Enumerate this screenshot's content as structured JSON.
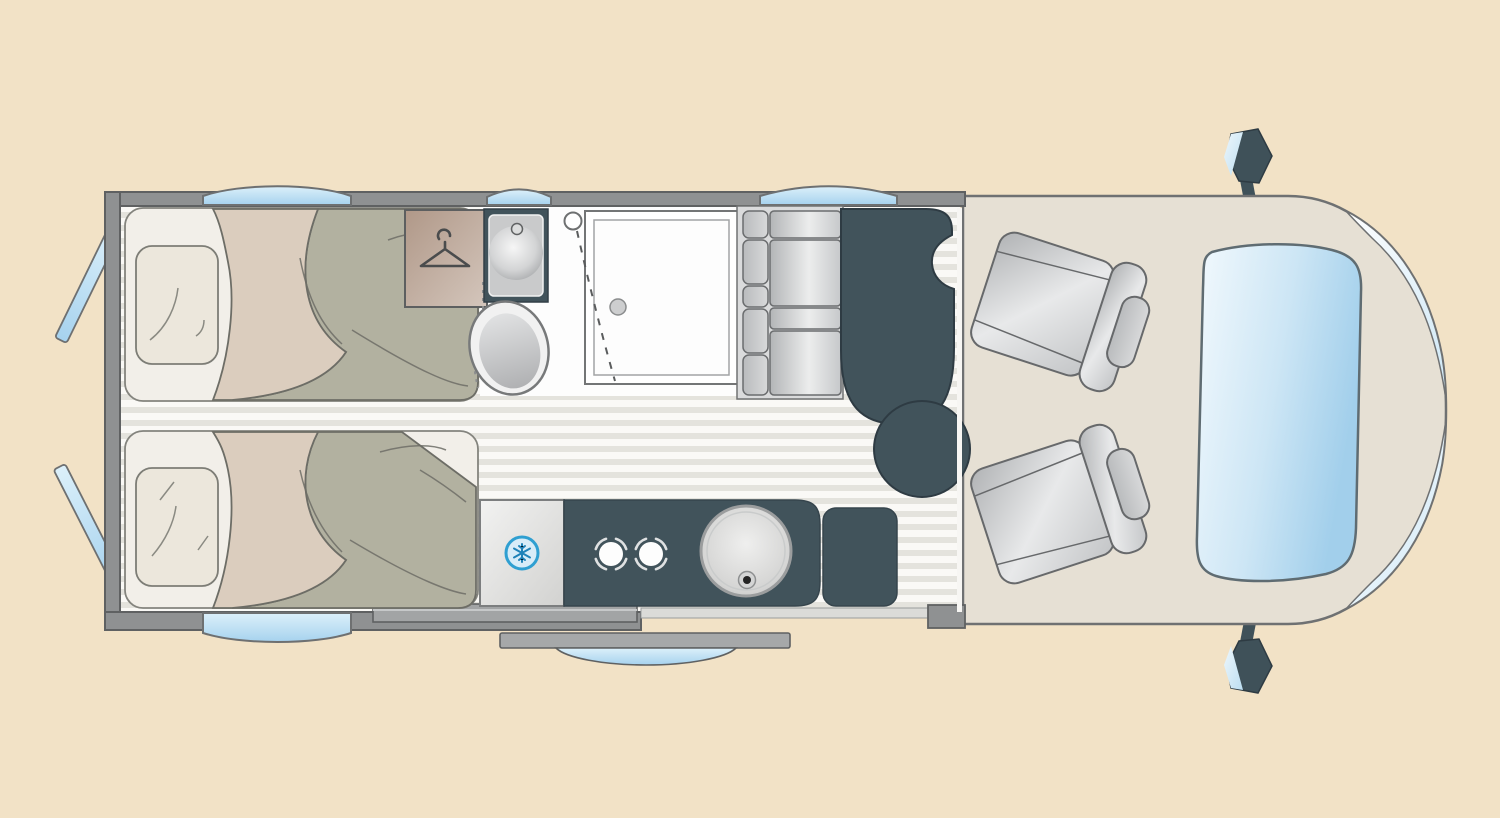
{
  "page": {
    "title": "Campervan floor plan (top view)",
    "type": "floorplan-diagram",
    "visible_text": "none"
  },
  "colors": {
    "background": "#f2e2c6",
    "wall": "#8f9192",
    "wall_outline": "#5f6162",
    "floor_base": "#faf9f6",
    "floor_stripe": "#e4e3dd",
    "bathroom_floor": "#fdfdfd",
    "cab_floor": "#e6e0d4",
    "dark_fixture": "#41535b",
    "table": "#41535b",
    "mattress": "#f2efe9",
    "pillow": "#ece7dc",
    "blanket": "#b2b1a0",
    "blanket_fold": "#dbcdbe",
    "wardrobe_brown": "#b49d90",
    "window_blue": "#aad5ef",
    "glass_light": "#d9effa",
    "accent_blue": "#2f9fd1",
    "snowflake_blue": "#1f82b8",
    "cushion_gray": "#c9cbcd",
    "step_gray": "#a2a4a5"
  },
  "elements": [
    {
      "name": "single-bed-top",
      "desc": "rear single bed with pillow and folded duvet"
    },
    {
      "name": "single-bed-bottom",
      "desc": "rear single bed with pillow and folded duvet"
    },
    {
      "name": "wardrobe",
      "desc": "wardrobe marked with clothes-hanger symbol"
    },
    {
      "name": "vanity-sink",
      "desc": "washroom basin in dark cabinet with faucet"
    },
    {
      "name": "toilet",
      "desc": "tilted toilet bowl"
    },
    {
      "name": "shower-tray",
      "desc": "square shower with drain and pivot door swing (dashed)"
    },
    {
      "name": "bench-seat",
      "desc": "two-place travel bench with headrests"
    },
    {
      "name": "dining-table",
      "desc": "dark tabletop with round extension leaf"
    },
    {
      "name": "refrigerator",
      "desc": "fridge marked with snowflake symbol"
    },
    {
      "name": "stove",
      "desc": "two-burner gas hob"
    },
    {
      "name": "kitchen-sink",
      "desc": "round sink bowl with drain"
    },
    {
      "name": "kitchen-side-cabinet",
      "desc": "small dark cabinet beside counter"
    },
    {
      "name": "swivel-seat-top",
      "desc": "cab captain seat swivelled toward living area"
    },
    {
      "name": "swivel-seat-bottom",
      "desc": "cab captain seat swivelled toward living area"
    },
    {
      "name": "windshield",
      "desc": "front windscreen glazing"
    },
    {
      "name": "corner-window-top",
      "desc": "cab corner glazing"
    },
    {
      "name": "corner-window-bottom",
      "desc": "cab corner glazing"
    },
    {
      "name": "side-mirror-top",
      "desc": "exterior mirror"
    },
    {
      "name": "side-mirror-bottom",
      "desc": "exterior mirror"
    },
    {
      "name": "window-top-rear",
      "desc": "side window over rear bed"
    },
    {
      "name": "window-top-washroom",
      "desc": "small side window over washroom"
    },
    {
      "name": "window-top-bench",
      "desc": "side window over bench"
    },
    {
      "name": "window-bottom-rear",
      "desc": "side window over lower bed"
    },
    {
      "name": "rear-door-window-top",
      "desc": "opened rear door window pane"
    },
    {
      "name": "rear-door-window-bottom",
      "desc": "opened rear door window pane"
    },
    {
      "name": "entry-step",
      "desc": "entry step plate at sliding door"
    },
    {
      "name": "sliding-door-open",
      "desc": "sliding entry door shown open outside body"
    }
  ]
}
